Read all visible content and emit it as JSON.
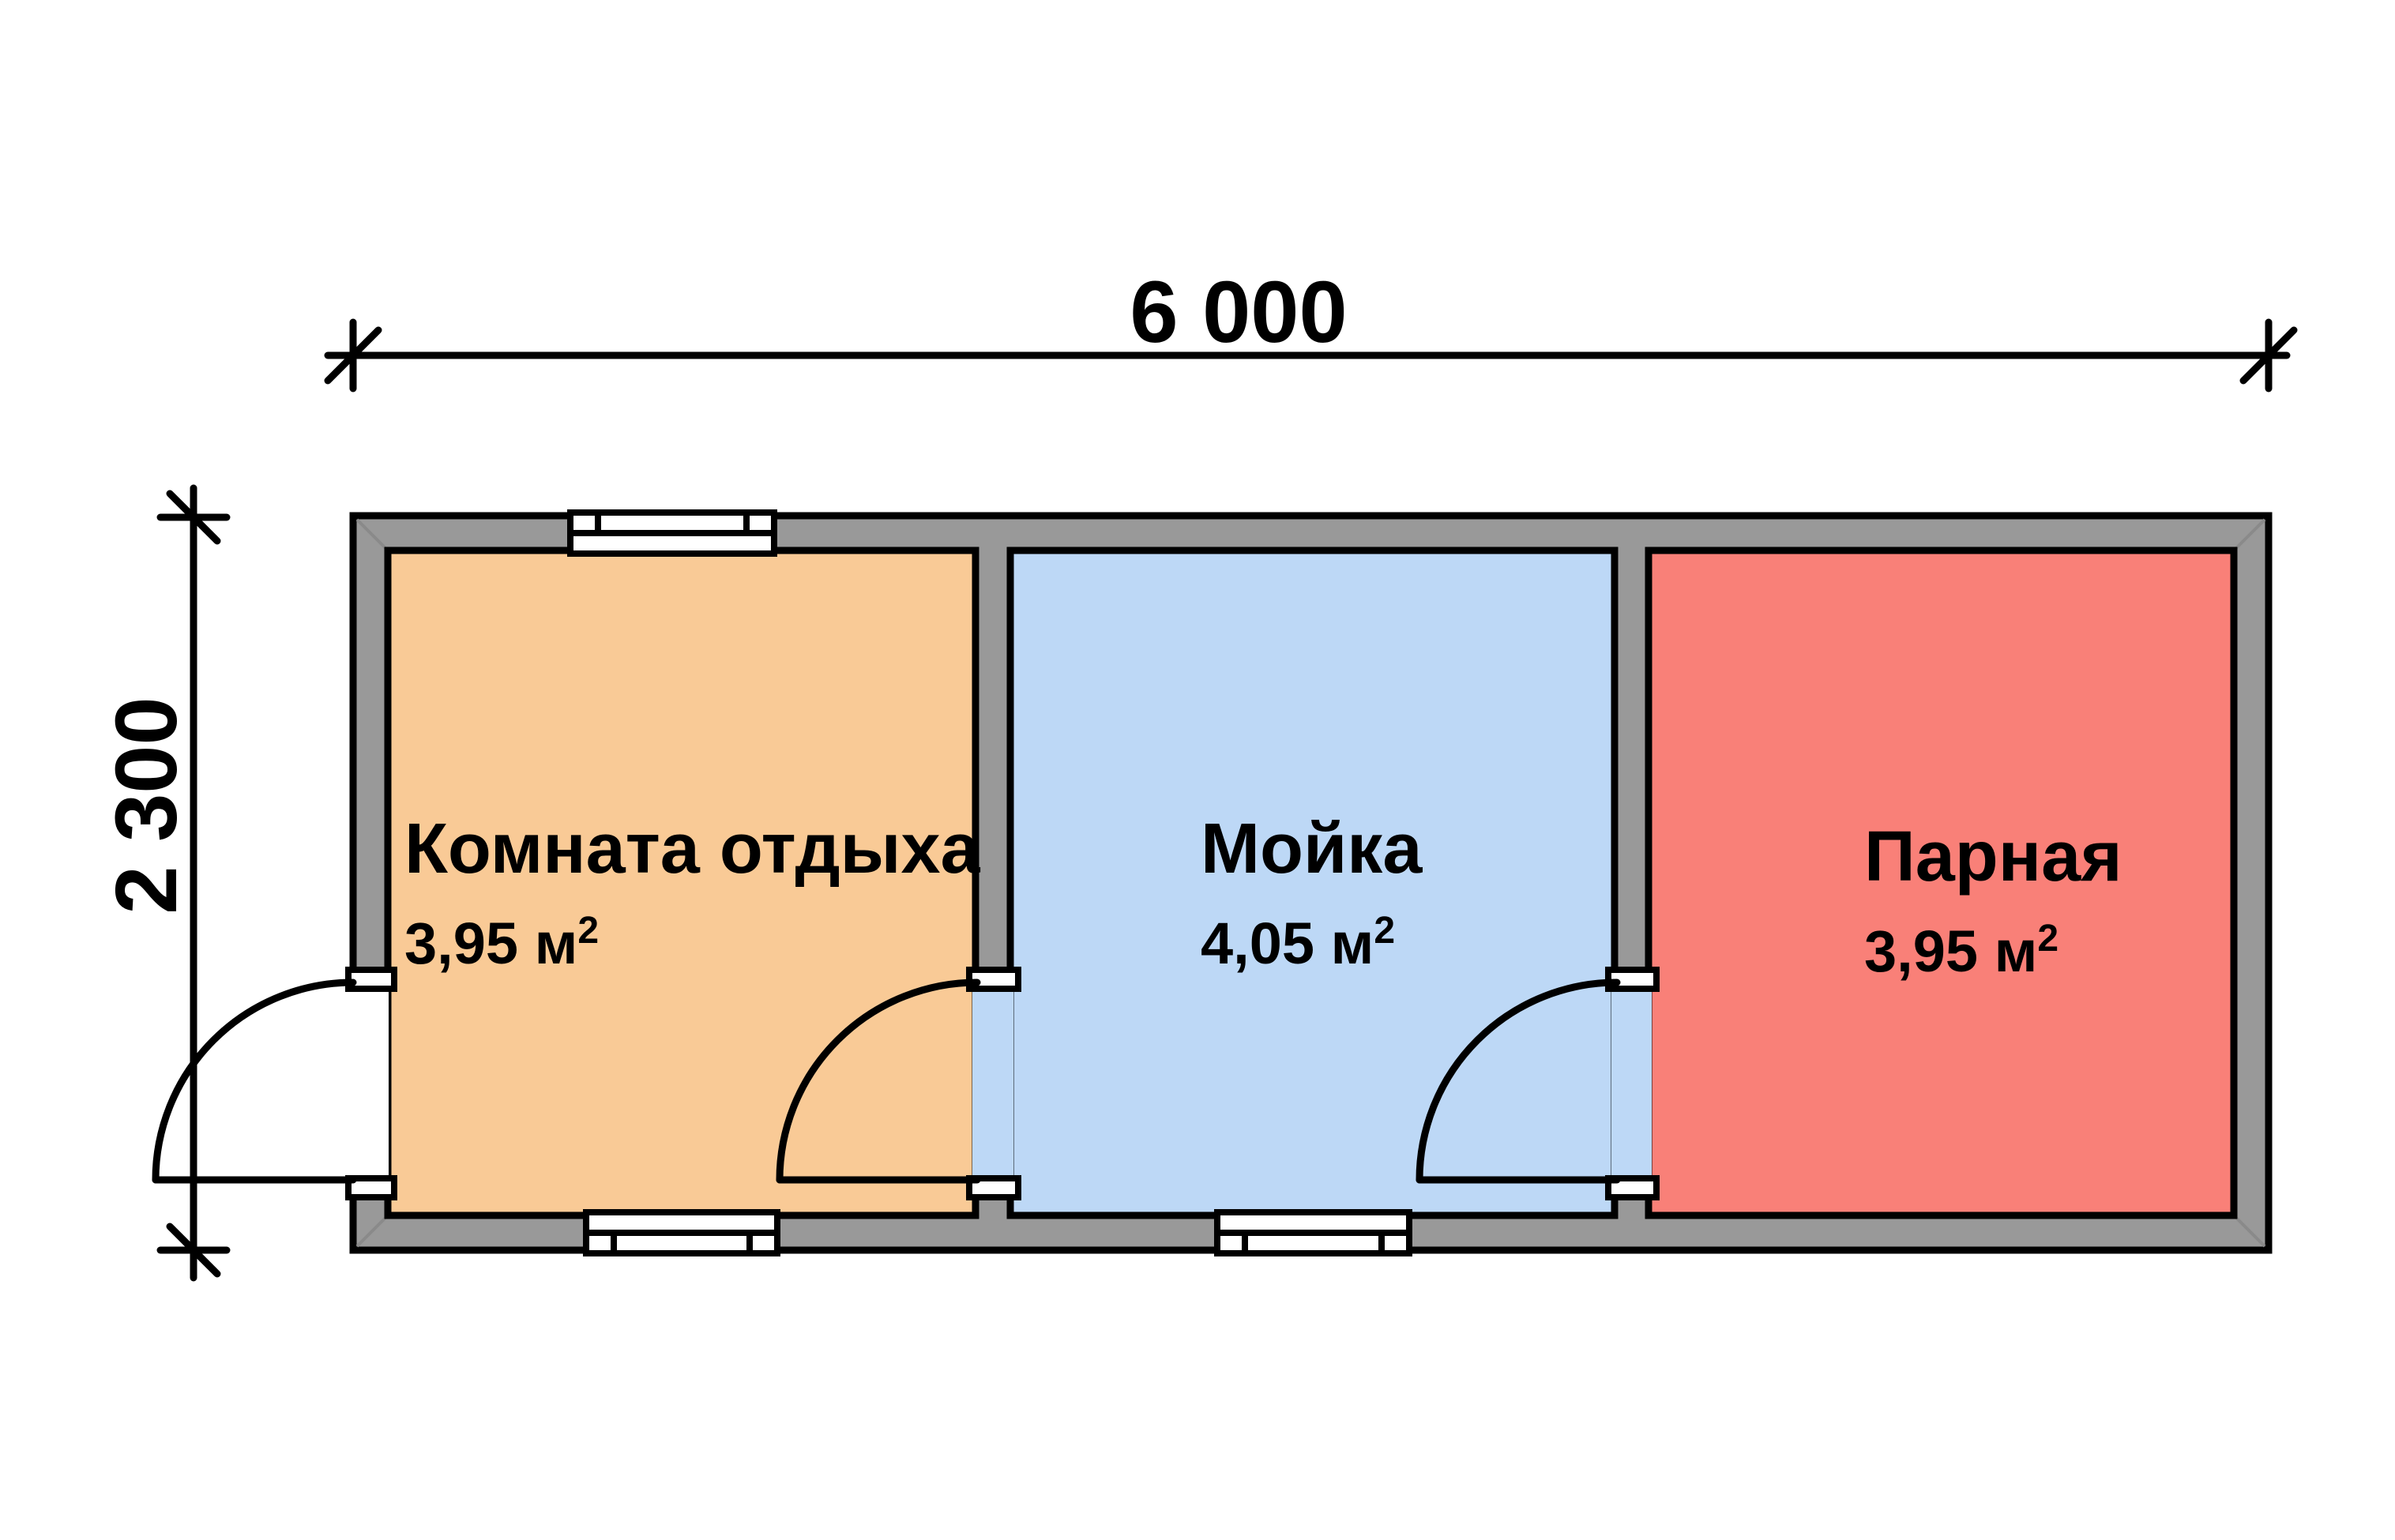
{
  "plan": {
    "dimensions": {
      "width_label": "6 000",
      "height_label": "2 300"
    },
    "rooms": [
      {
        "id": "rest",
        "name": "Комната отдыха",
        "area_label": "3,95 м",
        "area_sup": "2",
        "color": "#F9CA96"
      },
      {
        "id": "wash",
        "name": "Мойка",
        "area_label": "4,05 м",
        "area_sup": "2",
        "color": "#BDD8F6"
      },
      {
        "id": "steam",
        "name": "Парная",
        "area_label": "3,95 м",
        "area_sup": "2",
        "color": "#F98078"
      }
    ],
    "colors": {
      "wall": "#999999",
      "outline": "#000000",
      "opening": "#FFFFFF",
      "miter": "#8A8A8A"
    }
  }
}
